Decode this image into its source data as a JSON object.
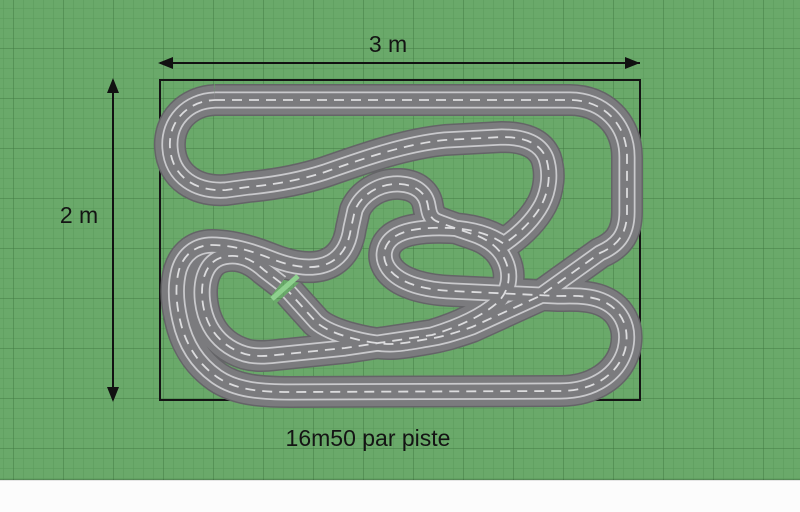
{
  "labels": {
    "width": "3 m",
    "height": "2 m",
    "caption": "16m50 par piste"
  },
  "diagram": {
    "type": "slot-car-track-plan",
    "area_width_label": "3 m",
    "area_height_label": "2 m",
    "lane_length_note": "16m50 par piste"
  },
  "colors": {
    "background": "#6AA96A",
    "below_plan": "#FCFCFC",
    "grid_minor": "rgba(15,70,15,0.16)",
    "grid_major": "rgba(8,55,8,0.32)",
    "boundary": "#141414",
    "track_edge": "#646467",
    "track_surface": "#7B7B7E",
    "lane_line": "#C9C9CC",
    "center_dash": "#DCDCDE",
    "gap_highlight": "#8ED08E",
    "dimension_line": "#111111"
  }
}
